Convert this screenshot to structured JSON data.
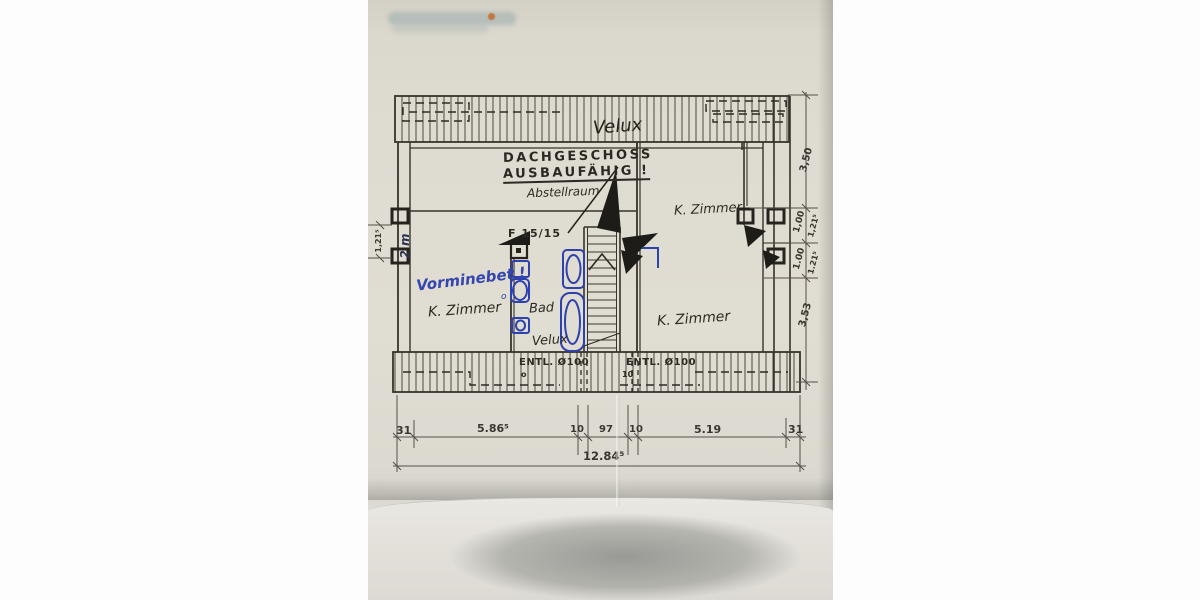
{
  "plan": {
    "roof_top_label": "Velux",
    "title": {
      "line1": "DACHGESCHOSS",
      "line2": "AUSBAUFÄHIG !"
    },
    "rooms": {
      "storage": "Abstellraum",
      "upper_right": "K. Zimmer",
      "left": "K. Zimmer",
      "bath": "Bad",
      "lower_right": "K. Zimmer"
    },
    "labels": {
      "chimney": "F 15/15",
      "note_blue": "Vorminebet !",
      "note_blue_mark": "o",
      "velux_bath": "Velux",
      "vent_left": "ENTL. Ø100",
      "vent_left_sub": "o",
      "vent_right": "ENTL. Ø100",
      "vent_right_sub": "10",
      "wall_note": "2 m"
    },
    "dimensions": {
      "bottom": [
        "31",
        "5.86⁵",
        "10",
        "97",
        "10",
        "5.19",
        "31"
      ],
      "bottom_total": "12.84⁵",
      "right": [
        "3,50",
        "1,00",
        "1,21⁵",
        "1.00",
        "1.21⁵",
        "3,53"
      ],
      "left": "1,21⁵"
    }
  }
}
